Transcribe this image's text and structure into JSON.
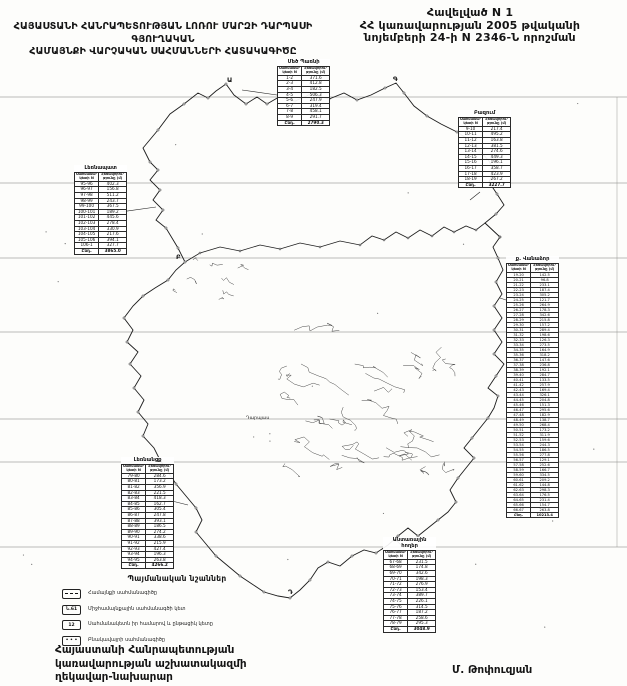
{
  "header": {
    "appendix_line1": "Հավելված N 1",
    "appendix_line2": "ՀՀ կառավարության 2005 թվականի",
    "appendix_line3": "նոյեմբերի 24-ի N 2346-Ն որոշման",
    "title_line1": "ՀԱՅԱՍՏԱՆԻ ՀԱՆՐԱՊԵՏՈՒԹՅԱՆ ԼՈՌՈՒ ՄԱՐԶԻ ԴԱՐՊԱՍԻ ԳՅՈՒՂԱԿԱՆ",
    "title_line2": "ՀԱՄԱՅՆՔԻ ՎԱՐՉԱԿԱՆ ՍԱՀՄԱՆՆԵՐԻ ՀԱՏԱԿԱԳԻԾԸ"
  },
  "map": {
    "settlement_label": "Դարպաս",
    "junction_letters": [
      "Ա",
      "Գ",
      "Բ",
      "Դ"
    ]
  },
  "table_header": [
    "Սահմանա-\nկետի N",
    "Հեռավորու-\nթյունը (մ)"
  ],
  "total_label": "Ընդ.",
  "tables": {
    "topCenter": {
      "title": "Մեծ Պառնի",
      "rows": [
        [
          "1-2",
          "371.6"
        ],
        [
          "2-3",
          "412.8"
        ],
        [
          "3-4",
          "182.5"
        ],
        [
          "4-5",
          "506.3"
        ],
        [
          "5-6",
          "247.9"
        ],
        [
          "6-7",
          "319.4"
        ],
        [
          "7-8",
          "458.1"
        ],
        [
          "8-9",
          "291.7"
        ]
      ],
      "total": "2790.3"
    },
    "topRight": {
      "title": "Բազում",
      "rows": [
        [
          "9-10",
          "217.4"
        ],
        [
          "10-11",
          "495.2"
        ],
        [
          "11-12",
          "163.8"
        ],
        [
          "12-13",
          "381.5"
        ],
        [
          "13-14",
          "274.6"
        ],
        [
          "14-15",
          "449.3"
        ],
        [
          "15-16",
          "196.1"
        ],
        [
          "16-17",
          "358.7"
        ],
        [
          "17-18",
          "423.9"
        ],
        [
          "18-19",
          "267.2"
        ]
      ],
      "total": "3227.7"
    },
    "left": {
      "title": "Լեռնապատ",
      "rows": [
        [
          "95-96",
          "402.3"
        ],
        [
          "96-97",
          "156.8"
        ],
        [
          "97-98",
          "511.2"
        ],
        [
          "98-99",
          "243.7"
        ],
        [
          "99-100",
          "367.5"
        ],
        [
          "100-101",
          "189.2"
        ],
        [
          "101-102",
          "445.6"
        ],
        [
          "102-103",
          "278.4"
        ],
        [
          "103-104",
          "330.9"
        ],
        [
          "104-105",
          "217.6"
        ],
        [
          "105-106",
          "394.1"
        ],
        [
          "106-1",
          "327.7"
        ]
      ],
      "total": "3865.0"
    },
    "rightTall": {
      "title": "ք. Վանաձոր",
      "rows": [
        [
          "19-20",
          "142.5"
        ],
        [
          "20-21",
          "96.8"
        ],
        [
          "21-22",
          "233.1"
        ],
        [
          "22-23",
          "187.4"
        ],
        [
          "23-24",
          "305.2"
        ],
        [
          "24-25",
          "121.7"
        ],
        [
          "25-26",
          "264.9"
        ],
        [
          "26-27",
          "178.3"
        ],
        [
          "27-28",
          "342.6"
        ],
        [
          "28-29",
          "215.8"
        ],
        [
          "29-30",
          "157.2"
        ],
        [
          "30-31",
          "289.4"
        ],
        [
          "31-32",
          "198.6"
        ],
        [
          "32-33",
          "126.3"
        ],
        [
          "33-34",
          "273.5"
        ],
        [
          "34-35",
          "164.9"
        ],
        [
          "35-36",
          "318.2"
        ],
        [
          "36-37",
          "147.6"
        ],
        [
          "37-38",
          "236.8"
        ],
        [
          "38-39",
          "192.1"
        ],
        [
          "39-40",
          "284.7"
        ],
        [
          "40-41",
          "133.5"
        ],
        [
          "41-42",
          "257.9"
        ],
        [
          "42-43",
          "169.4"
        ],
        [
          "43-44",
          "326.1"
        ],
        [
          "44-45",
          "204.8"
        ],
        [
          "45-46",
          "151.3"
        ],
        [
          "46-47",
          "295.6"
        ],
        [
          "47-48",
          "182.9"
        ],
        [
          "48-49",
          "138.7"
        ],
        [
          "49-50",
          "268.4"
        ],
        [
          "50-51",
          "173.2"
        ],
        [
          "51-52",
          "311.9"
        ],
        [
          "52-53",
          "159.6"
        ],
        [
          "53-54",
          "244.3"
        ],
        [
          "54-55",
          "186.5"
        ],
        [
          "55-56",
          "277.8"
        ],
        [
          "56-57",
          "129.1"
        ],
        [
          "57-58",
          "252.6"
        ],
        [
          "58-59",
          "166.7"
        ],
        [
          "59-60",
          "334.5"
        ],
        [
          "60-61",
          "209.2"
        ],
        [
          "61-62",
          "144.8"
        ],
        [
          "62-63",
          "298.3"
        ],
        [
          "63-64",
          "176.5"
        ],
        [
          "64-65",
          "231.4"
        ],
        [
          "65-66",
          "154.7"
        ],
        [
          "66-67",
          "263.8"
        ]
      ],
      "total": "10213.4"
    },
    "bottomLeft": {
      "title": "Լեռնանցք",
      "rows": [
        [
          "79-80",
          "284.6"
        ],
        [
          "80-81",
          "173.2"
        ],
        [
          "81-82",
          "356.9"
        ],
        [
          "82-83",
          "221.5"
        ],
        [
          "83-84",
          "418.3"
        ],
        [
          "84-85",
          "162.7"
        ],
        [
          "85-86",
          "305.4"
        ],
        [
          "86-87",
          "247.8"
        ],
        [
          "87-88",
          "393.1"
        ],
        [
          "88-89",
          "186.5"
        ],
        [
          "89-90",
          "274.2"
        ],
        [
          "90-91",
          "338.6"
        ],
        [
          "91-92",
          "215.9"
        ],
        [
          "92-93",
          "427.4"
        ],
        [
          "93-94",
          "196.3"
        ],
        [
          "94-95",
          "263.8"
        ]
      ],
      "total": "4266.2"
    },
    "bottomMiddle": {
      "title": "Անտառային\nհողեր",
      "rows": [
        [
          "67-68",
          "231.5"
        ],
        [
          "68-69",
          "174.8"
        ],
        [
          "69-70",
          "342.6"
        ],
        [
          "70-71",
          "198.3"
        ],
        [
          "71-72",
          "276.9"
        ],
        [
          "72-73",
          "153.4"
        ],
        [
          "73-74",
          "389.7"
        ],
        [
          "74-75",
          "226.1"
        ],
        [
          "75-76",
          "314.5"
        ],
        [
          "76-77",
          "187.2"
        ],
        [
          "77-78",
          "258.6"
        ],
        [
          "78-79",
          "295.3"
        ]
      ],
      "total": "3048.9"
    }
  },
  "legend": {
    "title": "Պայմանական նշաններ",
    "items": [
      {
        "symbol": "dash",
        "symbol_text": "",
        "label": "Համայնքի սահմանագիծը"
      },
      {
        "symbol": "text",
        "symbol_text": "Ն.61",
        "label": "Միջհամայնքային սահմանագծի կետ"
      },
      {
        "symbol": "text",
        "symbol_text": "12",
        "label": "Սահմանակետն իր համարով և ընթացիկ կետը"
      },
      {
        "symbol": "dots",
        "symbol_text": "• • •",
        "label": "Բնակավայրի սահմանագիծը"
      }
    ]
  },
  "footer": {
    "left_line1": "Հայաստանի Հանրապետության",
    "left_line2": "կառավարության աշխատակազմի",
    "left_line3": "ղեկավար-նախարար",
    "right_signature": "Մ. Թոփուզյան"
  }
}
